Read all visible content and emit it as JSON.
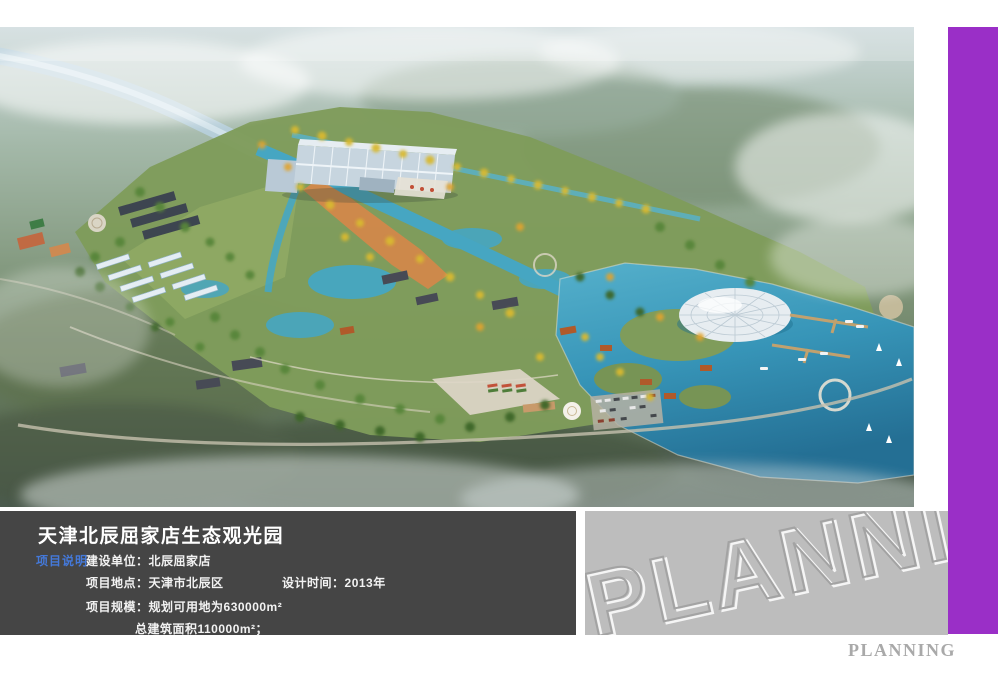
{
  "info_panel": {
    "title": "天津北辰屈家店生态观光园",
    "section_label": "项目说明",
    "fields": [
      {
        "label": "建设单位：",
        "value": "北辰屈家店"
      },
      {
        "label": "项目地点：",
        "value": "天津市北辰区"
      },
      {
        "label": "设计时间：",
        "value": "2013年"
      },
      {
        "label": "项目规模：",
        "value": "规划可用地为630000m²"
      },
      {
        "label": "",
        "value": "总建筑面积110000m²；"
      }
    ],
    "colors": {
      "background": "#454545",
      "title": "#ffffff",
      "section_label": "#4479da",
      "text": "#f2f2f2"
    }
  },
  "watermark": {
    "text": "PLANNING",
    "box_background": "#bdbdbd",
    "emboss_stroke": "#a3a3a3",
    "emboss_highlight": "#ffffff"
  },
  "footer": {
    "brand": "PLANNING",
    "color": "#a9a9a9"
  },
  "accent_bar": {
    "color": "#9a2fc7"
  },
  "rendering": {
    "description": "Aerial bird's-eye rendering of the eco-sightseeing park in mist",
    "palette": {
      "mist_sky": "#ccd9db",
      "far_land": "#4b5a4e",
      "park_green": "#7f9c5b",
      "canal_water": "#46a6c2",
      "lake_water": "#3795b8",
      "river": "#b6cfdb",
      "beach_sand": "#d2884a",
      "autumn_trees": "#d9b92f",
      "summer_trees": "#578538",
      "dome": "#e7edf1",
      "hall_roof": "#c7d5df",
      "pier": "#c9a26b",
      "road": "#c6c0ae"
    }
  }
}
